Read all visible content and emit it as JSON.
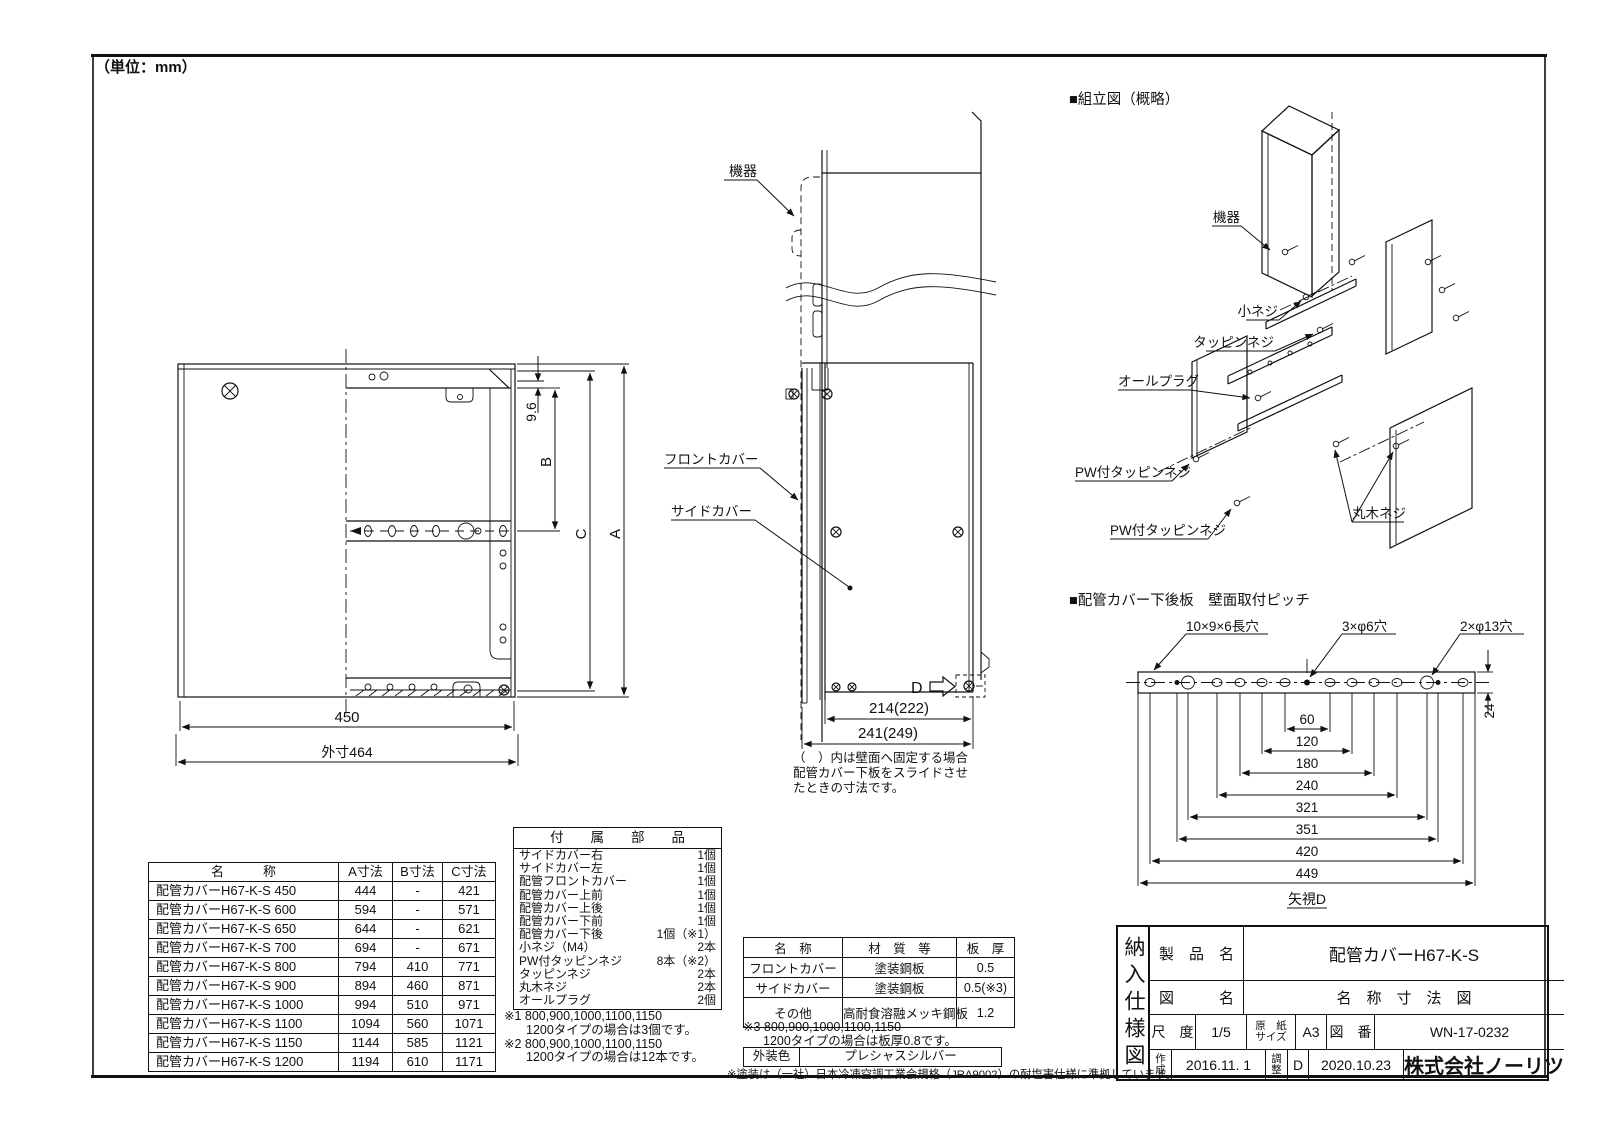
{
  "page": {
    "unit_note": "（単位：mm）",
    "paint_note": "※塗装は（一社）日本冷凍空調工業会規格（JRA9002）の耐塩害仕様に準拠しています。"
  },
  "front_view": {
    "dim_450": "450",
    "dim_outer": "外寸464",
    "dim_96": "9.6",
    "dim_a": "A",
    "dim_b": "B",
    "dim_c": "C"
  },
  "side_view": {
    "label_device": "機器",
    "label_front_cover": "フロントカバー",
    "label_side_cover": "サイドカバー",
    "label_d": "D",
    "dim_inner": "214(222)",
    "dim_outer": "241(249)",
    "note1": "（　）内は壁面へ固定する場合",
    "note2": "配管カバー下板をスライドさせ",
    "note3": "たときの寸法です。"
  },
  "assembly": {
    "title": "■組立図（概略）",
    "label_device": "機器",
    "label_small_screw": "小ネジ",
    "label_tapping": "タッピンネジ",
    "label_plug": "オールプラグ",
    "label_pw1": "PW付タッピンネジ",
    "label_pw2": "PW付タッピンネジ",
    "label_wood": "丸木ネジ"
  },
  "back_plate": {
    "title": "■配管カバー下後板　壁面取付ピッチ",
    "callout_slot": "10×9×6長穴",
    "callout_center": "3×φ6穴",
    "callout_large": "2×φ13穴",
    "dim_24": "24",
    "view": "矢視D",
    "dims": [
      "60",
      "120",
      "180",
      "240",
      "321",
      "351",
      "420",
      "449"
    ]
  },
  "size_table": {
    "headers": [
      "名　　　称",
      "A寸法",
      "B寸法",
      "C寸法"
    ],
    "rows": [
      [
        "配管カバーH67-K-S 450",
        "444",
        "-",
        "421"
      ],
      [
        "配管カバーH67-K-S 600",
        "594",
        "-",
        "571"
      ],
      [
        "配管カバーH67-K-S 650",
        "644",
        "-",
        "621"
      ],
      [
        "配管カバーH67-K-S 700",
        "694",
        "-",
        "671"
      ],
      [
        "配管カバーH67-K-S 800",
        "794",
        "410",
        "771"
      ],
      [
        "配管カバーH67-K-S 900",
        "894",
        "460",
        "871"
      ],
      [
        "配管カバーH67-K-S 1000",
        "994",
        "510",
        "971"
      ],
      [
        "配管カバーH67-K-S 1100",
        "1094",
        "560",
        "1071"
      ],
      [
        "配管カバーH67-K-S 1150",
        "1144",
        "585",
        "1121"
      ],
      [
        "配管カバーH67-K-S 1200",
        "1194",
        "610",
        "1171"
      ]
    ]
  },
  "accessories": {
    "title": "付　　属　　部　　品",
    "items": [
      {
        "name": "サイドカバー右",
        "qty": "1個"
      },
      {
        "name": "サイドカバー左",
        "qty": "1個"
      },
      {
        "name": "配管フロントカバー",
        "qty": "1個"
      },
      {
        "name": "配管カバー上前",
        "qty": "1個"
      },
      {
        "name": "配管カバー上後",
        "qty": "1個"
      },
      {
        "name": "配管カバー下前",
        "qty": "1個"
      },
      {
        "name": "配管カバー下後",
        "qty": "1個（※1）"
      },
      {
        "name": "小ネジ（M4）",
        "qty": "2本"
      },
      {
        "name": "PW付タッピンネジ",
        "qty": "8本（※2）"
      },
      {
        "name": "タッピンネジ",
        "qty": "2本"
      },
      {
        "name": "丸木ネジ",
        "qty": "2本"
      },
      {
        "name": "オールプラグ",
        "qty": "2個"
      }
    ],
    "note1": "※1 800,900,1000,1100,1150",
    "note1b": "1200タイプの場合は3個です。",
    "note2": "※2 800,900,1000,1100,1150",
    "note2b": "1200タイプの場合は12本です。"
  },
  "materials": {
    "headers": [
      "名　称",
      "材　質　等",
      "板　厚"
    ],
    "rows": [
      [
        "フロントカバー",
        "塗装鋼板",
        "0.5"
      ],
      [
        "サイドカバー",
        "塗装鋼板",
        "0.5(※3)"
      ],
      [
        "その他",
        "高耐食溶融メッキ鋼板",
        "1.2"
      ]
    ],
    "note1": "※3 800,900,1000,1100,1150",
    "note2": "1200タイプの場合は板厚0.8です。",
    "color_label": "外装色",
    "color_value": "プレシャスシルバー"
  },
  "title_block": {
    "doc_type": "納入仕様図",
    "product_label": "製　品　名",
    "product": "配管カバーH67-K-S",
    "drawing_label": "図　　　名",
    "drawing": "名　称　寸　法　図",
    "scale_label": "尺　度",
    "scale": "1/5",
    "paper_label_1": "原　紙",
    "paper_label_2": "サイズ",
    "paper": "A3",
    "no_label": "図　番",
    "number": "WN-17-0232",
    "created_1": "作",
    "created_2": "成",
    "created_date": "2016.11. 1",
    "adj_1": "調",
    "adj_2": "整",
    "rev": "D",
    "adj_date": "2020.10.23",
    "company": "株式会社ノーリツ"
  }
}
